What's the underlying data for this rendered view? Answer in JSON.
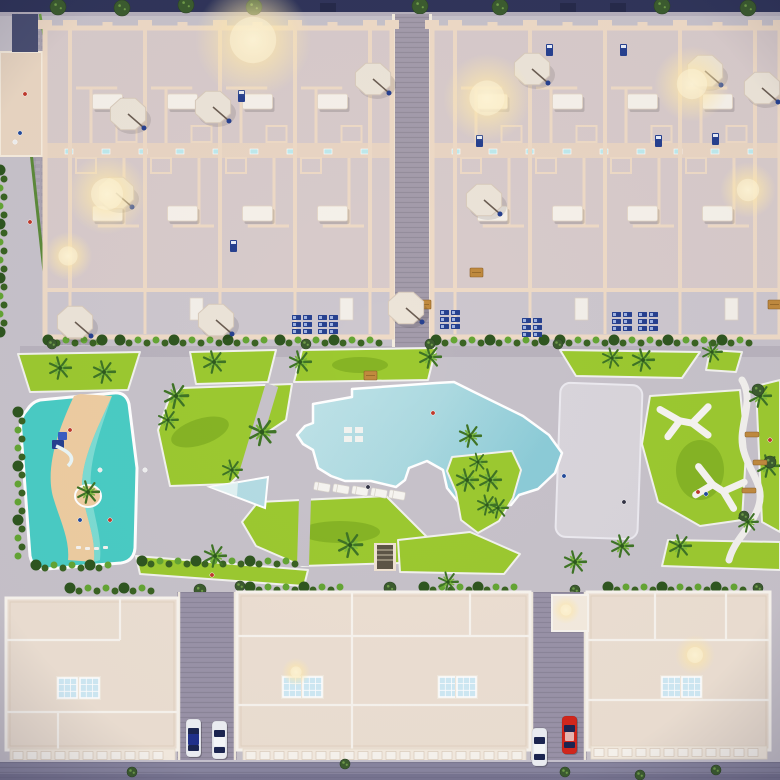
{
  "meta": {
    "description": "Top-down dusk aerial 3D render of a residential complex: two apartment blocks at top, central amenity deck with free-form pool, kids lazy-river pool, lawns, palm trees and playground, three roof-plan buildings at bottom with streets and parked cars"
  },
  "palette": {
    "pavement": "#c7c2ca",
    "roadGray": "#b9b3bd",
    "streetPurple": "#9a93a8",
    "topBand": "#30355a",
    "bottomRoad": "#8986a0",
    "bottomRoadDark": "#6e6b88",
    "wallCream": "#eedac6",
    "wallLight": "#f7ead8",
    "floorUnit": "#d8cbcb",
    "floorTerrace": "#cdc7ce",
    "corridor": "#e9d5c3",
    "roofCream": "#ecdfd2",
    "roofLight": "#f4ebdf",
    "parapet": "#f8f4ee",
    "lawn": "#9cc930",
    "lawnDark": "#86b425",
    "hedge": "#3a6323",
    "hedgeLight": "#64a534",
    "canopy": "#3c5c2f",
    "pool": "#b4dce3",
    "poolDeep": "#8ccbd7",
    "kidsWater": "#4accc4",
    "kidsLight": "#93e2da",
    "sand": "#eecda1",
    "white": "#f5f3f0",
    "navy": "#27418f",
    "skylight": "#cfe9f4",
    "tan": "#c08a3e",
    "glow": "#ffe8ae",
    "carRed": "#d3271b",
    "carBlue": "#20308b",
    "carWhite": "#edeff4"
  },
  "layout": {
    "rows": {
      "top": 28,
      "corridor_a": 143,
      "corridor_b": 158,
      "row2_end": 290,
      "terrace_end": 337
    },
    "top_blocks": [
      {
        "x0": 45,
        "x1": 392,
        "verticals": [
          70,
          145,
          220,
          295,
          370
        ]
      },
      {
        "x0": 432,
        "x1": 780,
        "verticals": [
          455,
          530,
          605,
          680,
          755
        ]
      }
    ],
    "bottom_buildings": [
      {
        "x": 6,
        "y": 598,
        "w": 172,
        "h": 152,
        "inner": [
          [
            "h",
            640,
            6,
            120
          ],
          [
            "v",
            120,
            598,
            640
          ],
          [
            "h",
            712,
            6,
            178
          ],
          [
            "v",
            58,
            712,
            750
          ]
        ]
      },
      {
        "x": 237,
        "y": 592,
        "w": 293,
        "h": 158,
        "inner": [
          [
            "h",
            636,
            237,
            530
          ],
          [
            "v",
            352,
            592,
            750
          ],
          [
            "h",
            705,
            237,
            530
          ],
          [
            "v",
            470,
            592,
            636
          ]
        ]
      },
      {
        "x": 587,
        "y": 592,
        "w": 183,
        "h": 158,
        "inner": [
          [
            "h",
            640,
            587,
            770
          ],
          [
            "v",
            655,
            592,
            640
          ],
          [
            "h",
            700,
            587,
            770
          ],
          [
            "v",
            726,
            592,
            640
          ]
        ]
      }
    ],
    "balconies": [
      [
        10,
        749,
        165
      ],
      [
        243,
        749,
        283
      ],
      [
        591,
        746,
        176
      ]
    ]
  },
  "objects": {
    "glows": [
      [
        253,
        40,
        58
      ],
      [
        487,
        98,
        44
      ],
      [
        692,
        84,
        38
      ],
      [
        107,
        194,
        40
      ],
      [
        748,
        190,
        28
      ],
      [
        68,
        256,
        24
      ],
      [
        296,
        672,
        14
      ],
      [
        695,
        655,
        20
      ],
      [
        566,
        610,
        14
      ]
    ],
    "umbrellas": [
      [
        128,
        114
      ],
      [
        213,
        107
      ],
      [
        373,
        79
      ],
      [
        532,
        69
      ],
      [
        705,
        71
      ],
      [
        762,
        88
      ],
      [
        116,
        193
      ],
      [
        484,
        200
      ],
      [
        75,
        322
      ],
      [
        216,
        320
      ],
      [
        406,
        308
      ],
      [
        34,
        675
      ],
      [
        496,
        672
      ],
      [
        566,
        608
      ]
    ],
    "palms": [
      [
        60,
        368,
        1
      ],
      [
        104,
        372,
        1
      ],
      [
        176,
        396,
        1.1
      ],
      [
        214,
        362,
        1
      ],
      [
        300,
        362,
        1
      ],
      [
        262,
        432,
        1.2
      ],
      [
        168,
        420,
        0.9
      ],
      [
        232,
        470,
        0.9
      ],
      [
        430,
        357,
        1
      ],
      [
        470,
        436,
        1
      ],
      [
        490,
        480,
        1
      ],
      [
        498,
        508,
        0.9
      ],
      [
        575,
        562,
        1
      ],
      [
        612,
        358,
        0.9
      ],
      [
        643,
        360,
        1
      ],
      [
        712,
        352,
        0.9
      ],
      [
        760,
        396,
        1
      ],
      [
        768,
        466,
        1
      ],
      [
        748,
        522,
        0.9
      ],
      [
        680,
        546,
        1
      ],
      [
        622,
        546,
        1
      ],
      [
        350,
        545,
        1.1
      ],
      [
        215,
        556,
        1
      ],
      [
        448,
        582,
        0.9
      ],
      [
        88,
        492,
        1
      ],
      [
        467,
        480,
        1
      ],
      [
        487,
        505,
        0.9
      ],
      [
        478,
        462,
        0.8
      ]
    ],
    "canopies": [
      [
        758,
        390,
        6
      ],
      [
        770,
        462,
        6
      ],
      [
        744,
        516,
        5
      ],
      [
        52,
        344,
        5
      ],
      [
        306,
        344,
        5
      ],
      [
        430,
        344,
        5
      ],
      [
        558,
        344,
        5
      ],
      [
        200,
        590,
        6
      ],
      [
        240,
        586,
        5
      ],
      [
        390,
        588,
        6
      ],
      [
        575,
        590,
        5
      ],
      [
        758,
        588,
        5
      ]
    ],
    "hedge_rows": [
      [
        48,
        341,
        60
      ],
      [
        120,
        341,
        150
      ],
      [
        280,
        341,
        108
      ],
      [
        436,
        341,
        118
      ],
      [
        560,
        341,
        196
      ],
      [
        70,
        589,
        92
      ],
      [
        250,
        588,
        96
      ],
      [
        424,
        588,
        102
      ],
      [
        608,
        588,
        144
      ],
      [
        142,
        562,
        160
      ],
      [
        36,
        566,
        80
      ]
    ],
    "hedge_cols": [
      [
        20,
        412,
        150
      ],
      [
        2,
        170,
        170
      ]
    ],
    "trees_topband": [
      [
        58,
        7
      ],
      [
        122,
        8
      ],
      [
        186,
        5
      ],
      [
        254,
        7
      ],
      [
        420,
        6
      ],
      [
        500,
        7
      ],
      [
        662,
        6
      ],
      [
        748,
        8
      ]
    ],
    "planters_topband": [
      [
        320,
        3
      ],
      [
        560,
        3
      ],
      [
        610,
        3
      ]
    ],
    "bushes_bottom": [
      [
        132,
        772
      ],
      [
        345,
        764
      ],
      [
        565,
        772
      ],
      [
        716,
        770
      ],
      [
        640,
        775
      ]
    ],
    "skylights": [
      [
        58,
        678
      ],
      [
        80,
        678
      ],
      [
        283,
        677
      ],
      [
        303,
        677
      ],
      [
        439,
        677
      ],
      [
        457,
        677
      ],
      [
        662,
        677
      ],
      [
        682,
        677
      ]
    ],
    "navy_clusters": [
      [
        292,
        315
      ],
      [
        318,
        315
      ],
      [
        440,
        310
      ],
      [
        522,
        318
      ],
      [
        612,
        312
      ],
      [
        638,
        312
      ]
    ],
    "navy_items": [
      [
        238,
        90
      ],
      [
        230,
        240
      ],
      [
        476,
        135
      ],
      [
        546,
        44
      ],
      [
        620,
        44
      ],
      [
        655,
        135
      ],
      [
        712,
        133
      ],
      [
        88,
        598
      ],
      [
        99,
        598
      ],
      [
        110,
        598
      ],
      [
        437,
        595
      ],
      [
        450,
        595
      ],
      [
        623,
        675
      ]
    ],
    "tan_items": [
      [
        150,
        630
      ],
      [
        112,
        666
      ],
      [
        686,
        650
      ],
      [
        266,
        600
      ],
      [
        656,
        606
      ],
      [
        470,
        268
      ],
      [
        418,
        300
      ],
      [
        768,
        300
      ],
      [
        364,
        371
      ]
    ],
    "loungers": [
      [
        322,
        487
      ],
      [
        341,
        489
      ],
      [
        360,
        491
      ],
      [
        379,
        493
      ],
      [
        397,
        495
      ]
    ],
    "benches": [
      [
        745,
        432
      ],
      [
        753,
        460
      ],
      [
        742,
        488
      ]
    ],
    "y_structures": [
      [
        686,
        422,
        -8
      ],
      [
        718,
        488,
        14
      ]
    ],
    "cars": [
      {
        "x": 194,
        "y": 738,
        "kind": "blue"
      },
      {
        "x": 220,
        "y": 740,
        "kind": "white"
      },
      {
        "x": 540,
        "y": 747,
        "kind": "white"
      },
      {
        "x": 570,
        "y": 735,
        "kind": "red"
      }
    ],
    "people": [
      [
        25,
        94,
        "#c0392b"
      ],
      [
        20,
        133,
        "#234a9a"
      ],
      [
        15,
        142,
        "#eeeeee"
      ],
      [
        30,
        222,
        "#c0392b"
      ],
      [
        368,
        487,
        "#333344"
      ],
      [
        433,
        413,
        "#c0392b"
      ],
      [
        564,
        476,
        "#234a9a"
      ],
      [
        624,
        502,
        "#333344"
      ],
      [
        212,
        575,
        "#c0392b"
      ],
      [
        145,
        470,
        "#eeeeee"
      ],
      [
        770,
        440,
        "#c0392b"
      ],
      [
        698,
        492,
        "#c0392b"
      ],
      [
        706,
        494,
        "#234a9a"
      ],
      [
        70,
        430,
        "#c0392b"
      ],
      [
        100,
        470,
        "#eeeeee"
      ],
      [
        80,
        520,
        "#234a9a"
      ],
      [
        110,
        520,
        "#c0392b"
      ]
    ]
  }
}
